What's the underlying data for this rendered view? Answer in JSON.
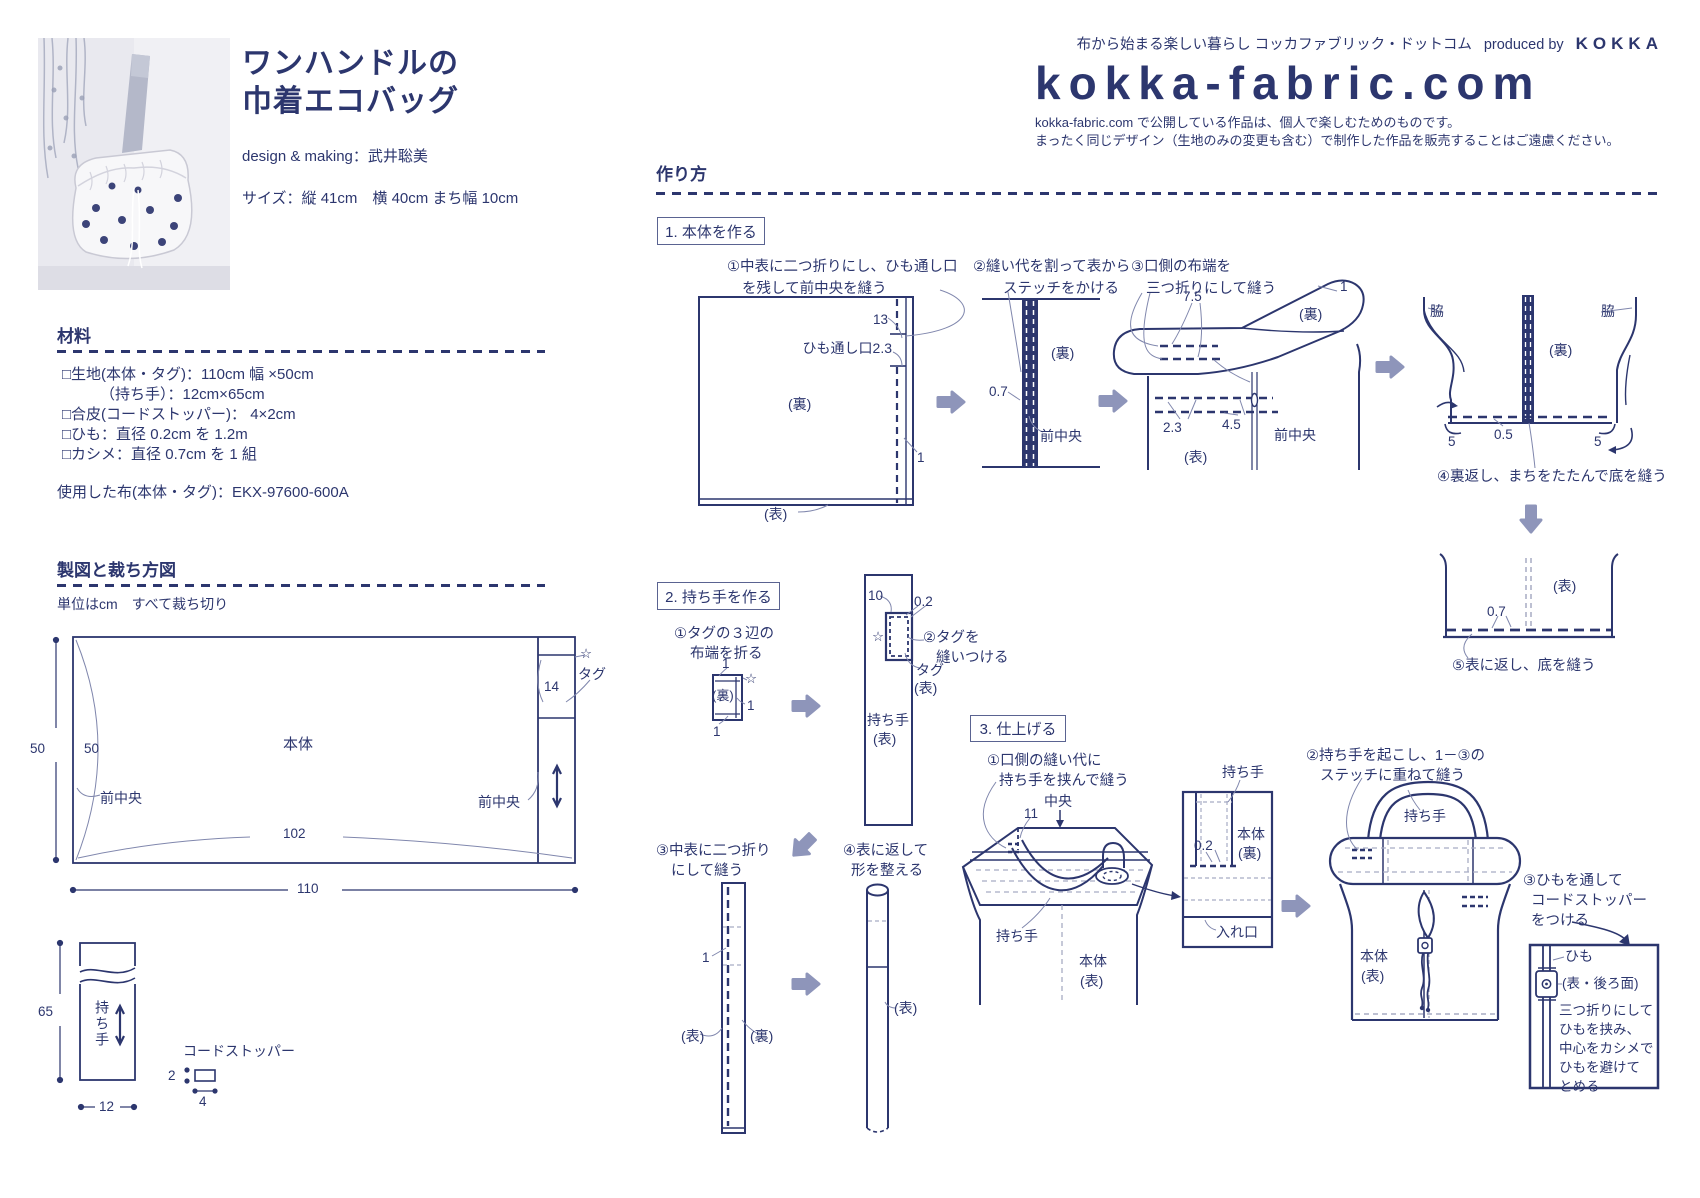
{
  "colors": {
    "ink": "#2c366e",
    "arrow": "#8e95ba",
    "leader": "#8087ad",
    "guide": "#a7acc4"
  },
  "brand": {
    "tagline": "布から始まる楽しい暮らし コッカファブリック・ドットコム",
    "produced_by": "produced by",
    "brand_name": "KOKKA",
    "logo": "kokka-fabric.com",
    "notice1": "kokka-fabric.com で公開している作品は、個人で楽しむためのものです。",
    "notice2": "まったく同じデザイン（生地のみの変更も含む）で制作した作品を販売することはご遠慮ください。"
  },
  "product": {
    "title1": "ワンハンドルの",
    "title2": "巾着エコバッグ",
    "credit": "design & making：武井聡美",
    "size": "サイズ：縦 41cm　横 40cm  まち幅 10cm"
  },
  "materials": {
    "heading": "材料",
    "item1": "□生地(本体・タグ)：110cm 幅 ×50cm",
    "item2": "（持ち手）：12cm×65cm",
    "item3": "□合皮(コードストッパー)： 4×2cm",
    "item4": "□ひも：直径 0.2cm を 1.2m",
    "item5": "□カシメ：直径 0.7cm を 1 組",
    "fabric_used": "使用した布(本体・タグ)：EKX-97600-600A"
  },
  "pattern": {
    "heading": "製図と裁ち方図",
    "note": "単位はcm　すべて裁ち切り",
    "dim50_outer": "50",
    "dim50_inner": "50",
    "front_center_left": "前中央",
    "front_center_right": "前中央",
    "body": "本体",
    "dim102": "102",
    "dim110": "110",
    "dim14": "14",
    "star": "☆",
    "tag": "タグ",
    "dim65": "65",
    "handle": "持ち手",
    "dim12": "12",
    "cord_stopper": "コードストッパー",
    "dim2": "2",
    "dim4": "4"
  },
  "howto": {
    "heading": "作り方",
    "sec1": {
      "box": "1. 本体を作る",
      "s1a": "①中表に二つ折りにし、ひも通し口",
      "s1b": "を残して前中央を縫う",
      "d1": {
        "n13": "13",
        "himo": "ひも通し口2.3",
        "ura": "(裏)",
        "n1": "1",
        "omote": "(表)"
      },
      "s2a": "②縫い代を割って表から",
      "s2b": "ステッチをかける",
      "d2": {
        "n07": "0.7",
        "ura": "(裏)",
        "maechuo": "前中央"
      },
      "s3a": "③口側の布端を",
      "s3b": "三つ折りにして縫う",
      "d3": {
        "n75": "7.5",
        "n1": "1",
        "ura": "(裏)",
        "n23": "2.3",
        "n45": "4.5",
        "maechuo": "前中央",
        "omote": "(表)"
      },
      "s4": "④裏返し、まちをたたんで底を縫う",
      "d4": {
        "waki_l": "脇",
        "waki_r": "脇",
        "ura": "(裏)",
        "n5l": "5",
        "n05": "0.5",
        "n5r": "5"
      },
      "s5": "⑤表に返し、底を縫う",
      "d5": {
        "omote": "(表)",
        "n07": "0.7"
      }
    },
    "sec2": {
      "box": "2. 持ち手を作る",
      "s1a": "①タグの３辺の",
      "s1b": "布端を折る",
      "d1": {
        "n1t": "1",
        "star": "☆",
        "ura": "(裏)",
        "n1r": "1",
        "n1b": "1"
      },
      "s2a": "②タグを",
      "s2b": "縫いつける",
      "d2": {
        "n10": "10",
        "n02": "0.2",
        "star": "☆",
        "tag": "タグ",
        "tag2": "(表)",
        "handle": "持ち手",
        "handle2": "(表)"
      },
      "s3a": "③中表に二つ折り",
      "s3b": "にして縫う",
      "d3": {
        "n1": "1",
        "omote": "(表)",
        "ura": "(裏)"
      },
      "s4a": "④表に返して",
      "s4b": "形を整える",
      "d4": {
        "omote": "(表)"
      }
    },
    "sec3": {
      "box": "3. 仕上げる",
      "s1a": "①口側の縫い代に",
      "s1b": "持ち手を挟んで縫う",
      "d1": {
        "chuo": "中央",
        "n11": "11",
        "handle": "持ち手",
        "body": "本体",
        "body2": "(表)"
      },
      "detail1": {
        "handle": "持ち手",
        "n02": "0.2",
        "body": "本体",
        "body2": "(裏)",
        "ireguchi": "入れ口"
      },
      "s2a": "②持ち手を起こし、1－③の",
      "s2b": "ステッチに重ねて縫う",
      "d2": {
        "handle": "持ち手",
        "body": "本体",
        "body2": "(表)"
      },
      "s3a": "③ひもを通して",
      "s3b": "コードストッパー",
      "s3c": "をつける",
      "detail3": {
        "himo": "ひも",
        "side": "(表・後ろ面)",
        "t1": "三つ折りにして",
        "t2": "ひもを挟み、",
        "t3": "中心をカシメで",
        "t4": "ひもを避けて",
        "t5": "とめる"
      }
    }
  }
}
